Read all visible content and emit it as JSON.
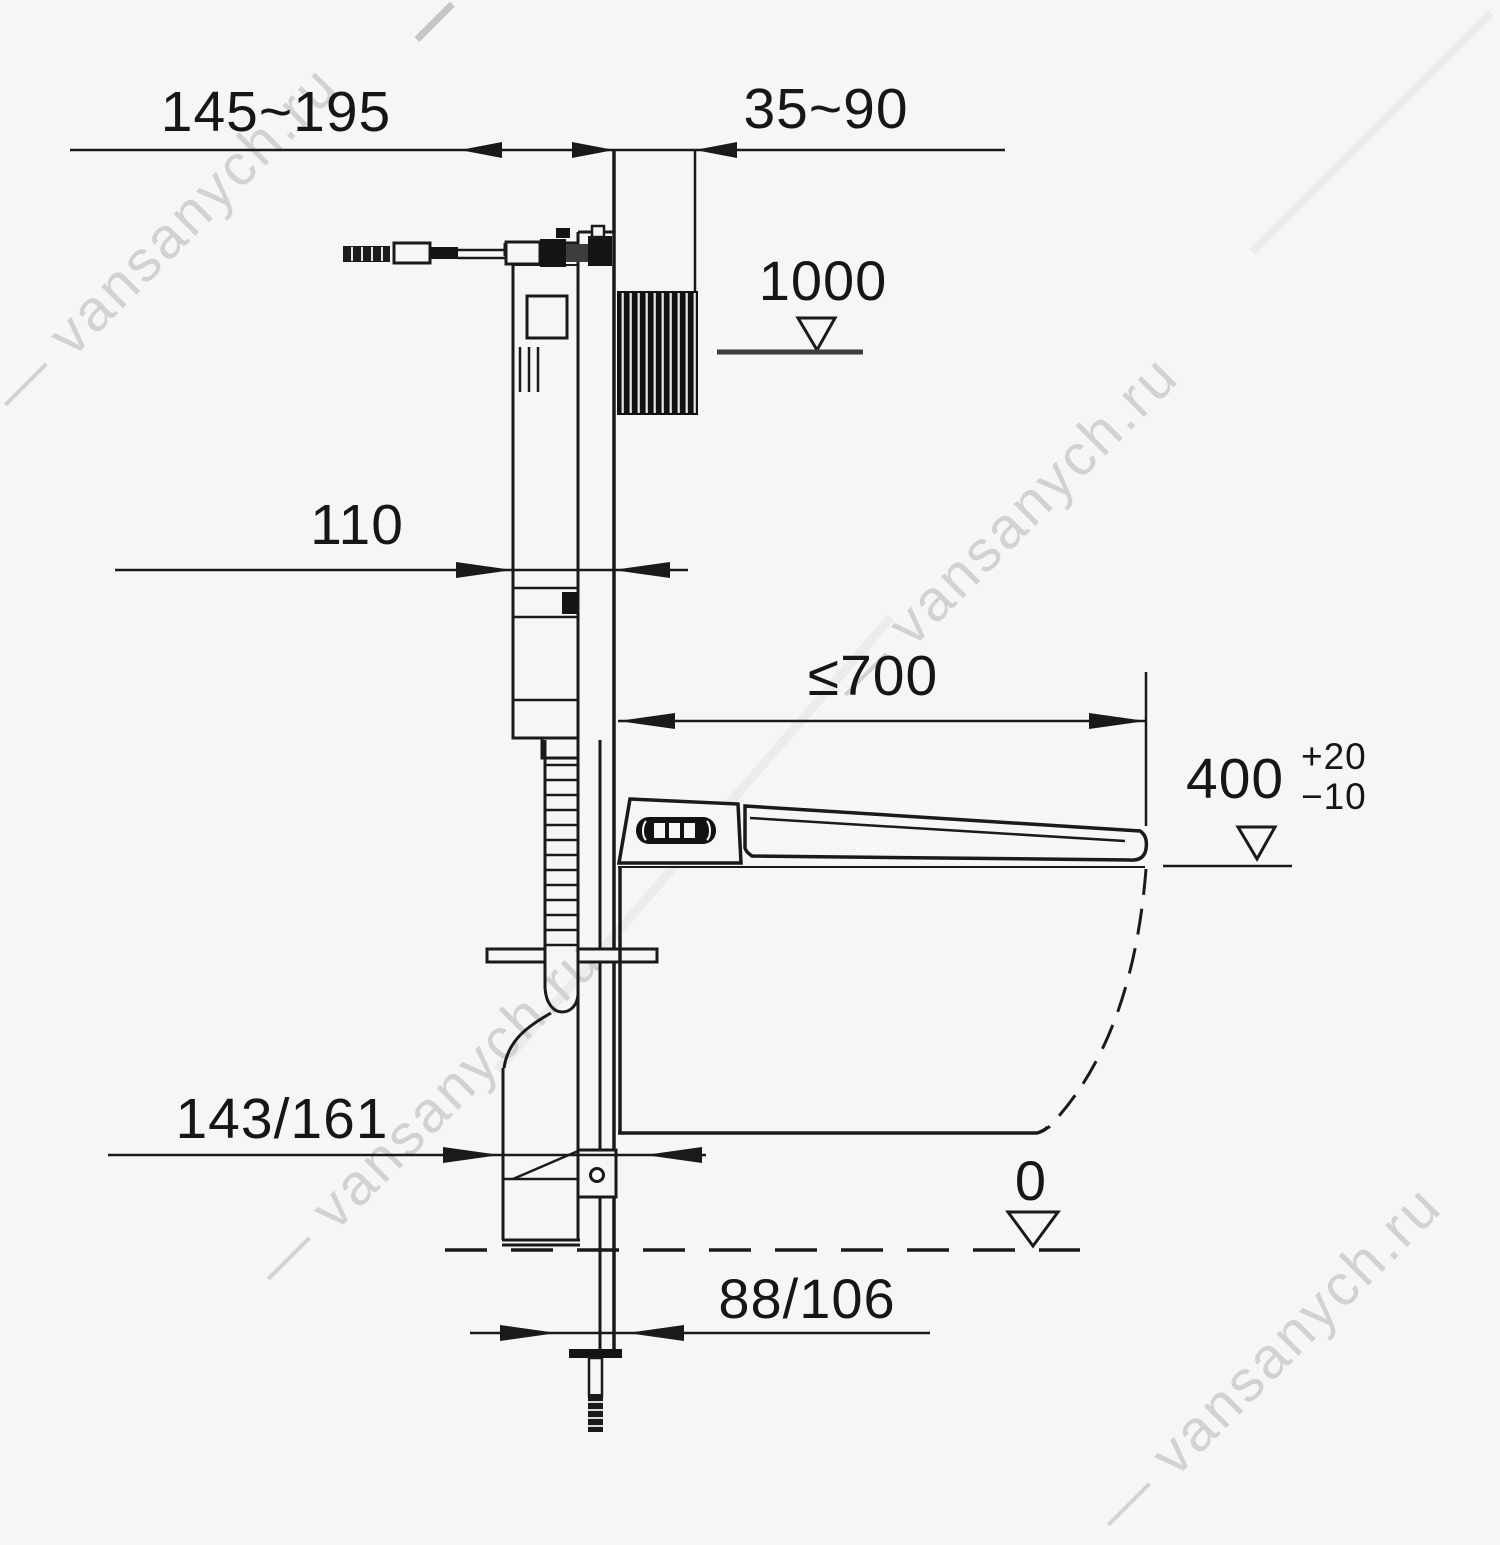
{
  "page": {
    "background": "#f6f6f6",
    "line_color": "#1a1a1a",
    "watermark_color": "#d2d2d2"
  },
  "watermark": {
    "text": "— vansanych.ru"
  },
  "drawing": {
    "type": "installation-diagram",
    "subject": "wall-hung toilet concealed cistern frame, side view with installation dimensions",
    "units": "mm",
    "dimensions": {
      "d_supply_offset": "145~195",
      "d_wall_gap": "35~90",
      "d_panel_height": "1000",
      "d_frame_depth": "110",
      "d_bowl_depth": "≤700",
      "d_seat_height": "400",
      "d_seat_height_tol_plus": "+20",
      "d_seat_height_tol_minus": "−10",
      "d_drain_offset_upper": "143/161",
      "d_floor_level": "0",
      "d_drain_offset_lower": "88/106"
    }
  }
}
